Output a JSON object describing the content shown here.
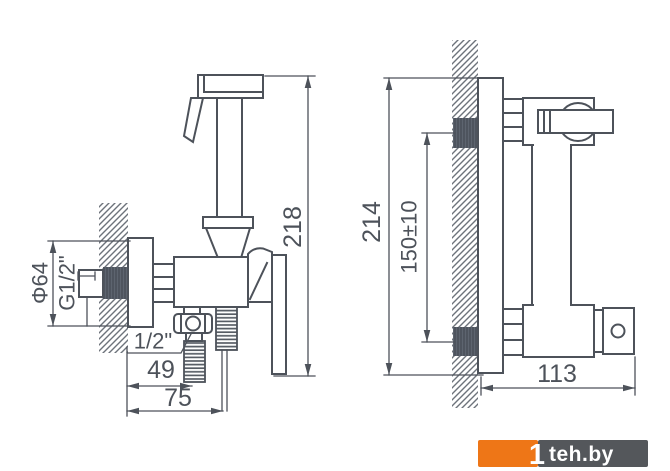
{
  "dimensions": {
    "front": {
      "total_height": "218",
      "escutcheon_diameter": "Φ64",
      "wall_thread": "G1/2\"",
      "outlet_thread": "1/2\"",
      "outlet_offset": "49",
      "outlet_depth": "75"
    },
    "side": {
      "body_height": "214",
      "inlet_spacing": "150±10",
      "depth": "113"
    }
  },
  "watermark": {
    "symbol": "1",
    "text": "teh.by",
    "orange_color": "#EE7617",
    "gray_color": "#54575B",
    "text_color": "#FFFFFF"
  },
  "colors": {
    "background": "#FFFFFF",
    "line": "#4D525A",
    "thread_fill": "#4E545E",
    "hatch": "#6D737B"
  }
}
